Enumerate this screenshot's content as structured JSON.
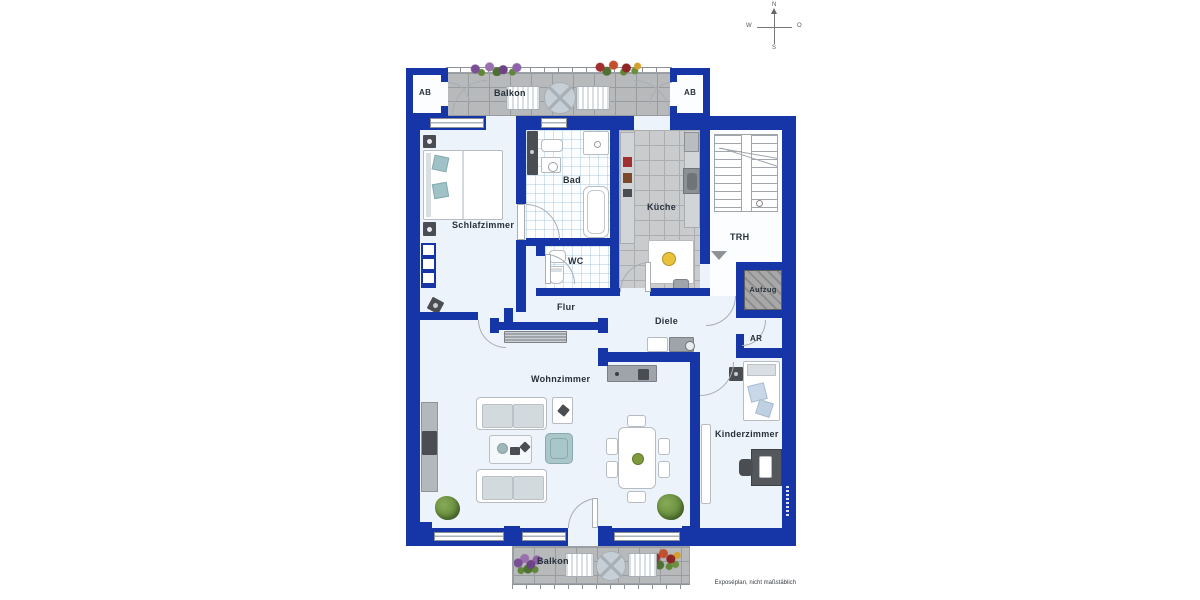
{
  "caption": "Exposéplan, nicht maßstäblich",
  "compass": {
    "north": "N",
    "east": "O",
    "south": "S",
    "west": "W"
  },
  "labels": {
    "balkon_top": "Balkon",
    "ab_left": "AB",
    "ab_right": "AB",
    "schlafzimmer": "Schlafzimmer",
    "bad": "Bad",
    "kueche": "Küche",
    "wc": "WC",
    "trh": "TRH",
    "aufzug": "Aufzug",
    "flur": "Flur",
    "diele": "Diele",
    "ar": "AR",
    "wohnzimmer": "Wohnzimmer",
    "kinderzimmer": "Kinderzimmer",
    "balkon_bottom": "Balkon"
  },
  "colors": {
    "wall": "#1635a7",
    "floor": "#edf3fa",
    "balcony_tile": "#b7b9bb",
    "kitchen_tile": "#c9cbcd",
    "bath_tile": "#fcfdfe",
    "elevator": "#a8a8a8",
    "label_text": "#27313c",
    "furniture_teal": "#a9c7cb",
    "plant_green": "#5f8737"
  }
}
